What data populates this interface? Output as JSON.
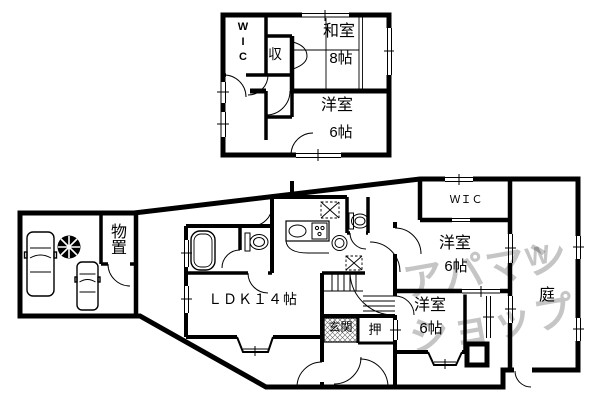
{
  "floor2": {
    "rooms": {
      "wic": {
        "label": "WIC"
      },
      "shuno": {
        "label": "収"
      },
      "washitsu": {
        "label": "和室",
        "size": "8帖"
      },
      "youshitsu": {
        "label": "洋室",
        "size": "6帖"
      }
    }
  },
  "floor1": {
    "rooms": {
      "monooki": {
        "label": "物置"
      },
      "ldk": {
        "label": "ＬＤＫ１４帖"
      },
      "genkan": {
        "label": "玄関"
      },
      "oshiire": {
        "label": "押"
      },
      "youshitsu_mid": {
        "label": "洋室",
        "size": "6帖"
      },
      "youshitsu_south": {
        "label": "洋室",
        "size": "6帖"
      },
      "wic": {
        "label": "ＷＩＣ"
      },
      "niwa": {
        "label": "庭"
      }
    }
  },
  "watermark": {
    "line1": "アパマン",
    "line2": "ショップ",
    "logo": "W"
  },
  "colors": {
    "wall": "#000000",
    "watermark": "#c5c5c5",
    "background": "#ffffff"
  }
}
